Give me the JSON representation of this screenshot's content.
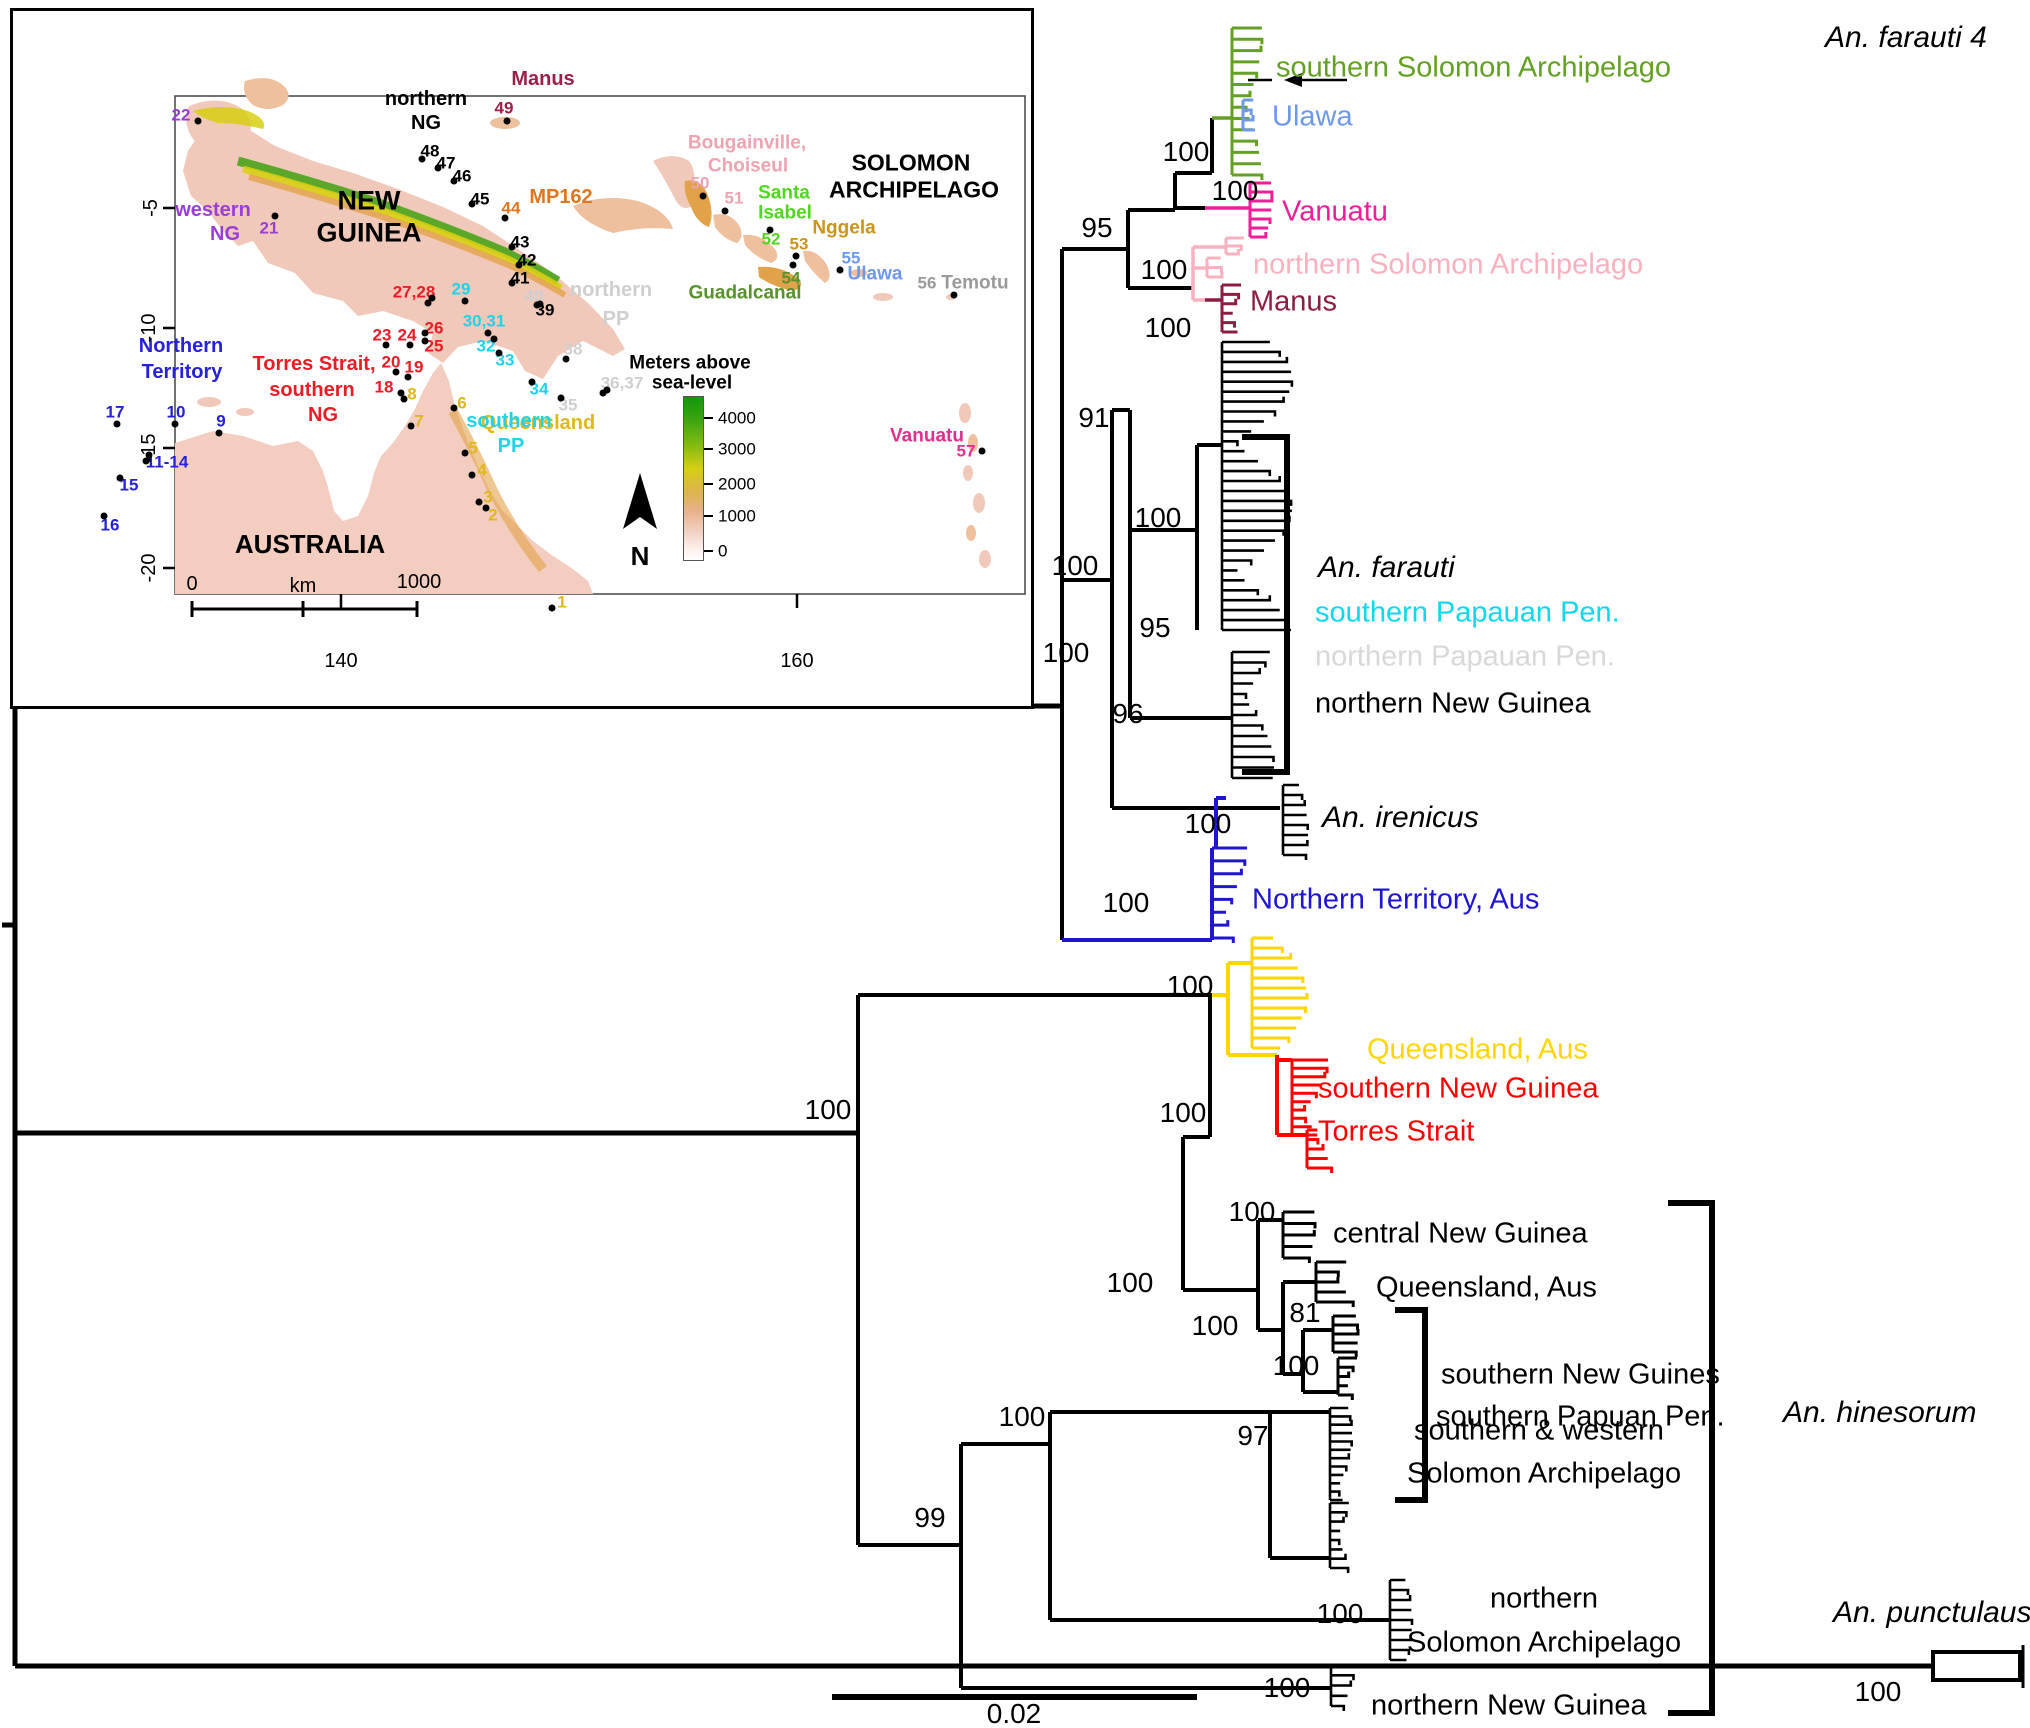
{
  "figure": {
    "scale_bar_label": "0.02"
  },
  "tree": {
    "colors": {
      "green": "#64a023",
      "ulawa_blue": "#6f98ea",
      "magenta": "#ef1f9a",
      "pink": "#f9b1c0",
      "dark_red": "#8c1d45",
      "nt_blue": "#2016d2",
      "yellow": "#ffd503",
      "red": "#fe0000",
      "cyan": "#0fd7ef",
      "light_gray": "#d8d8d8",
      "black": "#000000"
    },
    "species_labels": [
      {
        "text": "An. farauti 4",
        "x": 1825,
        "y": 38
      },
      {
        "text": "An. farauti",
        "x": 1318,
        "y": 568
      },
      {
        "text": "An. irenicus",
        "x": 1322,
        "y": 818
      },
      {
        "text": "An. hinesorum",
        "x": 1783,
        "y": 1413
      },
      {
        "text": "An. punctulaus",
        "x": 1833,
        "y": 1613
      }
    ],
    "tip_labels": [
      {
        "text": "southern Solomon Archipelago",
        "color": "#64a023",
        "x": 1276,
        "y": 68
      },
      {
        "text": "Ulawa",
        "color": "#6f98ea",
        "x": 1272,
        "y": 117
      },
      {
        "text": "Vanuatu",
        "color": "#ef1f9a",
        "x": 1282,
        "y": 212
      },
      {
        "text": "northern Solomon Archipelago",
        "color": "#f9b1c0",
        "x": 1253,
        "y": 265
      },
      {
        "text": "Manus",
        "color": "#8c1d45",
        "x": 1250,
        "y": 302
      },
      {
        "text": "southern Papauan Pen.",
        "color": "#0fd7ef",
        "x": 1315,
        "y": 613
      },
      {
        "text": "northern Papauan Pen.",
        "color": "#d8d8d8",
        "x": 1315,
        "y": 657
      },
      {
        "text": "northern New Guinea",
        "color": "#000000",
        "x": 1315,
        "y": 704
      },
      {
        "text": "Northern Territory, Aus",
        "color": "#2016d2",
        "x": 1252,
        "y": 900
      },
      {
        "text": "Queensland, Aus",
        "color": "#ffd503",
        "x": 1367,
        "y": 1050
      },
      {
        "text": "southern New Guinea",
        "color": "#fe0000",
        "x": 1318,
        "y": 1089
      },
      {
        "text": "Torres Strait",
        "color": "#fe0000",
        "x": 1318,
        "y": 1132
      },
      {
        "text": "central New Guinea",
        "color": "#000000",
        "x": 1333,
        "y": 1234
      },
      {
        "text": "Queensland, Aus",
        "color": "#000000",
        "x": 1376,
        "y": 1288
      },
      {
        "text": "southern New Guines",
        "color": "#000000",
        "x": 1441,
        "y": 1375
      },
      {
        "text": "southern Papuan Pen.",
        "color": "#000000",
        "x": 1436,
        "y": 1417
      },
      {
        "text": "southern & western",
        "color": "#000000",
        "x": 1414,
        "y": 1431
      },
      {
        "text": "Solomon Archipelago",
        "color": "#000000",
        "x": 1407,
        "y": 1474
      },
      {
        "text": "northern",
        "color": "#000000",
        "x": 1490,
        "y": 1599
      },
      {
        "text": "Solomon Archipelago",
        "color": "#000000",
        "x": 1407,
        "y": 1643
      },
      {
        "text": "northern New Guinea",
        "color": "#000000",
        "x": 1371,
        "y": 1706
      }
    ],
    "bootstraps": [
      {
        "value": "100",
        "x": 1186,
        "y": 152
      },
      {
        "value": "100",
        "x": 1235,
        "y": 191
      },
      {
        "value": "95",
        "x": 1097,
        "y": 228
      },
      {
        "value": "100",
        "x": 1164,
        "y": 270
      },
      {
        "value": "100",
        "x": 1168,
        "y": 328
      },
      {
        "value": "91",
        "x": 1094,
        "y": 418
      },
      {
        "value": "100",
        "x": 1075,
        "y": 566
      },
      {
        "value": "100",
        "x": 1158,
        "y": 518
      },
      {
        "value": "95",
        "x": 1155,
        "y": 628
      },
      {
        "value": "96",
        "x": 1128,
        "y": 714
      },
      {
        "value": "100",
        "x": 1208,
        "y": 824
      },
      {
        "value": "100",
        "x": 1126,
        "y": 903
      },
      {
        "value": "100",
        "x": 1066,
        "y": 653
      },
      {
        "value": "100",
        "x": 1190,
        "y": 986
      },
      {
        "value": "100",
        "x": 1183,
        "y": 1113
      },
      {
        "value": "100",
        "x": 828,
        "y": 1110
      },
      {
        "value": "100",
        "x": 1130,
        "y": 1283
      },
      {
        "value": "100",
        "x": 1252,
        "y": 1212
      },
      {
        "value": "100",
        "x": 1215,
        "y": 1326
      },
      {
        "value": "81",
        "x": 1305,
        "y": 1313
      },
      {
        "value": "100",
        "x": 1296,
        "y": 1366
      },
      {
        "value": "97",
        "x": 1253,
        "y": 1436
      },
      {
        "value": "100",
        "x": 1022,
        "y": 1417
      },
      {
        "value": "99",
        "x": 930,
        "y": 1518
      },
      {
        "value": "100",
        "x": 1340,
        "y": 1614
      },
      {
        "value": "100",
        "x": 1287,
        "y": 1688
      },
      {
        "value": "100",
        "x": 1878,
        "y": 1692
      }
    ]
  },
  "map": {
    "labels": [
      {
        "text": "NEW",
        "x": 356,
        "y": 190,
        "color": "#000000",
        "size": 27,
        "bold": true
      },
      {
        "text": "GUINEA",
        "x": 356,
        "y": 222,
        "color": "#000000",
        "size": 27,
        "bold": true
      },
      {
        "text": "northern",
        "x": 413,
        "y": 88,
        "color": "#000000",
        "size": 20,
        "bold": true
      },
      {
        "text": "NG",
        "x": 413,
        "y": 112,
        "color": "#000000",
        "size": 20,
        "bold": true
      },
      {
        "text": "SOLOMON",
        "x": 898,
        "y": 152,
        "color": "#000000",
        "size": 23,
        "bold": true
      },
      {
        "text": "ARCHIPELAGO",
        "x": 901,
        "y": 179,
        "color": "#000000",
        "size": 23,
        "bold": true
      },
      {
        "text": "AUSTRALIA",
        "x": 297,
        "y": 533,
        "color": "#000000",
        "size": 26,
        "bold": true
      },
      {
        "text": "western",
        "x": 200,
        "y": 199,
        "color": "#9a3fd6",
        "size": 20,
        "bold": true
      },
      {
        "text": "NG",
        "x": 212,
        "y": 223,
        "color": "#9a3fd6",
        "size": 20,
        "bold": true
      },
      {
        "text": "Torres Strait,",
        "x": 301,
        "y": 353,
        "color": "#ea1c25",
        "size": 20,
        "bold": true
      },
      {
        "text": "southern",
        "x": 299,
        "y": 379,
        "color": "#ea1c25",
        "size": 20,
        "bold": true
      },
      {
        "text": "NG",
        "x": 310,
        "y": 404,
        "color": "#ea1c25",
        "size": 20,
        "bold": true
      },
      {
        "text": "Northern",
        "x": 168,
        "y": 335,
        "color": "#2721d8",
        "size": 20,
        "bold": true
      },
      {
        "text": "Territory",
        "x": 169,
        "y": 361,
        "color": "#2721d8",
        "size": 20,
        "bold": true
      },
      {
        "text": "Queensland",
        "x": 525,
        "y": 412,
        "color": "#e0b81e",
        "size": 20,
        "bold": true
      },
      {
        "text": "MP162",
        "x": 548,
        "y": 186,
        "color": "#e0761d",
        "size": 20,
        "bold": true
      },
      {
        "text": "Manus",
        "x": 530,
        "y": 68,
        "color": "#9c1f4b",
        "size": 20,
        "bold": true
      },
      {
        "text": "Bougainville,",
        "x": 734,
        "y": 132,
        "color": "#eda3b2",
        "size": 19,
        "bold": true
      },
      {
        "text": "Choiseul",
        "x": 735,
        "y": 155,
        "color": "#eda3b2",
        "size": 19,
        "bold": true
      },
      {
        "text": "Santa",
        "x": 771,
        "y": 182,
        "color": "#52d61f",
        "size": 19,
        "bold": true
      },
      {
        "text": "Isabel",
        "x": 772,
        "y": 202,
        "color": "#52d61f",
        "size": 19,
        "bold": true
      },
      {
        "text": "Nggela",
        "x": 831,
        "y": 217,
        "color": "#c9951d",
        "size": 19,
        "bold": true
      },
      {
        "text": "Guadalcanal",
        "x": 732,
        "y": 282,
        "color": "#58912d",
        "size": 19,
        "bold": true
      },
      {
        "text": "Ulawa",
        "x": 862,
        "y": 263,
        "color": "#6f98ea",
        "size": 19,
        "bold": true
      },
      {
        "text": "Temotu",
        "x": 962,
        "y": 272,
        "color": "#9a9a9a",
        "size": 19,
        "bold": true
      },
      {
        "text": "Vanuatu",
        "x": 914,
        "y": 425,
        "color": "#e0308f",
        "size": 19,
        "bold": true
      },
      {
        "text": "northern",
        "x": 598,
        "y": 279,
        "color": "#cfcfcf",
        "size": 20,
        "bold": true
      },
      {
        "text": "PP",
        "x": 603,
        "y": 308,
        "color": "#cfcfcf",
        "size": 20,
        "bold": true
      },
      {
        "text": "southern",
        "x": 496,
        "y": 410,
        "color": "#1fd3ea",
        "size": 20,
        "bold": true
      },
      {
        "text": "PP",
        "x": 498,
        "y": 435,
        "color": "#1fd3ea",
        "size": 20,
        "bold": true
      }
    ],
    "sites": [
      {
        "text": "1",
        "x": 549,
        "y": 591,
        "color": "#e0b81e"
      },
      {
        "text": "2",
        "x": 480,
        "y": 504,
        "color": "#e0b81e"
      },
      {
        "text": "3",
        "x": 475,
        "y": 486,
        "color": "#e0b81e"
      },
      {
        "text": "4",
        "x": 469,
        "y": 459,
        "color": "#e0b81e"
      },
      {
        "text": "5",
        "x": 460,
        "y": 437,
        "color": "#e0b81e"
      },
      {
        "text": "6",
        "x": 449,
        "y": 392,
        "color": "#e0b81e"
      },
      {
        "text": "7",
        "x": 406,
        "y": 410,
        "color": "#e0b81e"
      },
      {
        "text": "8",
        "x": 399,
        "y": 383,
        "color": "#e0b81e"
      },
      {
        "text": "9",
        "x": 208,
        "y": 410,
        "color": "#2721d8"
      },
      {
        "text": "10",
        "x": 163,
        "y": 401,
        "color": "#2721d8"
      },
      {
        "text": "11-14",
        "x": 154,
        "y": 451,
        "color": "#2721d8"
      },
      {
        "text": "15",
        "x": 116,
        "y": 474,
        "color": "#2721d8"
      },
      {
        "text": "16",
        "x": 97,
        "y": 514,
        "color": "#2721d8"
      },
      {
        "text": "17",
        "x": 102,
        "y": 401,
        "color": "#2721d8"
      },
      {
        "text": "18",
        "x": 371,
        "y": 376,
        "color": "#ea1c25"
      },
      {
        "text": "19",
        "x": 401,
        "y": 356,
        "color": "#ea1c25"
      },
      {
        "text": "20",
        "x": 378,
        "y": 351,
        "color": "#ea1c25"
      },
      {
        "text": "21",
        "x": 256,
        "y": 217,
        "color": "#9a3fd6"
      },
      {
        "text": "22",
        "x": 168,
        "y": 104,
        "color": "#9a3fd6"
      },
      {
        "text": "23",
        "x": 369,
        "y": 324,
        "color": "#ea1c25"
      },
      {
        "text": "24",
        "x": 394,
        "y": 324,
        "color": "#ea1c25"
      },
      {
        "text": "25",
        "x": 421,
        "y": 335,
        "color": "#ea1c25"
      },
      {
        "text": "26",
        "x": 421,
        "y": 317,
        "color": "#ea1c25"
      },
      {
        "text": "27,28",
        "x": 401,
        "y": 281,
        "color": "#ea1c25"
      },
      {
        "text": "29",
        "x": 448,
        "y": 278,
        "color": "#1fd3ea"
      },
      {
        "text": "30,31",
        "x": 471,
        "y": 310,
        "color": "#1fd3ea"
      },
      {
        "text": "32",
        "x": 473,
        "y": 335,
        "color": "#1fd3ea"
      },
      {
        "text": "33",
        "x": 492,
        "y": 349,
        "color": "#1fd3ea"
      },
      {
        "text": "34",
        "x": 526,
        "y": 378,
        "color": "#1fd3ea"
      },
      {
        "text": "35",
        "x": 555,
        "y": 394,
        "color": "#cfcfcf"
      },
      {
        "text": "36,37",
        "x": 609,
        "y": 372,
        "color": "#cfcfcf"
      },
      {
        "text": "38",
        "x": 560,
        "y": 338,
        "color": "#cfcfcf"
      },
      {
        "text": "39",
        "x": 532,
        "y": 299,
        "color": "#000000"
      },
      {
        "text": "40",
        "x": 521,
        "y": 285,
        "color": "#cfcfcf"
      },
      {
        "text": "41",
        "x": 507,
        "y": 267,
        "color": "#000000"
      },
      {
        "text": "42",
        "x": 514,
        "y": 249,
        "color": "#000000"
      },
      {
        "text": "43",
        "x": 507,
        "y": 231,
        "color": "#000000"
      },
      {
        "text": "44",
        "x": 498,
        "y": 197,
        "color": "#e0761d"
      },
      {
        "text": "45",
        "x": 467,
        "y": 188,
        "color": "#000000"
      },
      {
        "text": "46",
        "x": 449,
        "y": 165,
        "color": "#000000"
      },
      {
        "text": "47",
        "x": 433,
        "y": 152,
        "color": "#000000"
      },
      {
        "text": "48",
        "x": 417,
        "y": 140,
        "color": "#000000"
      },
      {
        "text": "49",
        "x": 491,
        "y": 97,
        "color": "#9c1f4b"
      },
      {
        "text": "50",
        "x": 687,
        "y": 172,
        "color": "#eda3b2"
      },
      {
        "text": "51",
        "x": 721,
        "y": 187,
        "color": "#eda3b2"
      },
      {
        "text": "52",
        "x": 758,
        "y": 228,
        "color": "#52d61f"
      },
      {
        "text": "53",
        "x": 786,
        "y": 233,
        "color": "#c9951d"
      },
      {
        "text": "54",
        "x": 778,
        "y": 267,
        "color": "#58912d"
      },
      {
        "text": "55",
        "x": 838,
        "y": 247,
        "color": "#6f98ea"
      },
      {
        "text": "56",
        "x": 914,
        "y": 272,
        "color": "#9a9a9a"
      },
      {
        "text": "57",
        "x": 953,
        "y": 440,
        "color": "#e0308f"
      }
    ],
    "dots": [
      [
        539,
        597
      ],
      [
        473,
        497
      ],
      [
        466,
        491
      ],
      [
        459,
        464
      ],
      [
        452,
        442
      ],
      [
        441,
        397
      ],
      [
        398,
        415
      ],
      [
        391,
        388
      ],
      [
        388,
        382
      ],
      [
        395,
        366
      ],
      [
        383,
        361
      ],
      [
        373,
        334
      ],
      [
        397,
        334
      ],
      [
        412,
        330
      ],
      [
        412,
        322
      ],
      [
        415,
        292
      ],
      [
        419,
        287
      ],
      [
        452,
        290
      ],
      [
        475,
        322
      ],
      [
        481,
        328
      ],
      [
        486,
        342
      ],
      [
        519,
        371
      ],
      [
        548,
        387
      ],
      [
        594,
        379
      ],
      [
        590,
        382
      ],
      [
        553,
        348
      ],
      [
        527,
        293
      ],
      [
        524,
        294
      ],
      [
        499,
        272
      ],
      [
        506,
        254
      ],
      [
        499,
        236
      ],
      [
        459,
        193
      ],
      [
        441,
        170
      ],
      [
        425,
        157
      ],
      [
        409,
        148
      ],
      [
        492,
        207
      ],
      [
        494,
        110
      ],
      [
        262,
        205
      ],
      [
        185,
        110
      ],
      [
        206,
        422
      ],
      [
        162,
        413
      ],
      [
        136,
        444
      ],
      [
        133,
        450
      ],
      [
        107,
        467
      ],
      [
        91,
        505
      ],
      [
        104,
        413
      ],
      [
        690,
        185
      ],
      [
        712,
        200
      ],
      [
        757,
        219
      ],
      [
        783,
        245
      ],
      [
        780,
        254
      ],
      [
        827,
        259
      ],
      [
        941,
        284
      ],
      [
        969,
        440
      ]
    ],
    "axis": {
      "y_ticks": [
        {
          "text": "-5",
          "x": 138,
          "y": 197
        },
        {
          "text": "-10",
          "x": 136,
          "y": 317
        },
        {
          "text": "-15",
          "x": 136,
          "y": 437
        },
        {
          "text": "-20",
          "x": 136,
          "y": 557
        }
      ],
      "x_ticks": [
        {
          "text": "140",
          "x": 328,
          "y": 650
        },
        {
          "text": "160",
          "x": 784,
          "y": 650
        }
      ]
    },
    "legend": {
      "title1": "Meters above",
      "title2": "sea-level",
      "ticks": [
        {
          "text": "4000",
          "y": 407
        },
        {
          "text": "3000",
          "y": 438
        },
        {
          "text": "2000",
          "y": 473
        },
        {
          "text": "1000",
          "y": 505
        },
        {
          "text": "0",
          "y": 540
        }
      ]
    },
    "scalebar": {
      "left_label": "0",
      "unit": "km",
      "right_label": "1000"
    },
    "north_label": "N"
  }
}
